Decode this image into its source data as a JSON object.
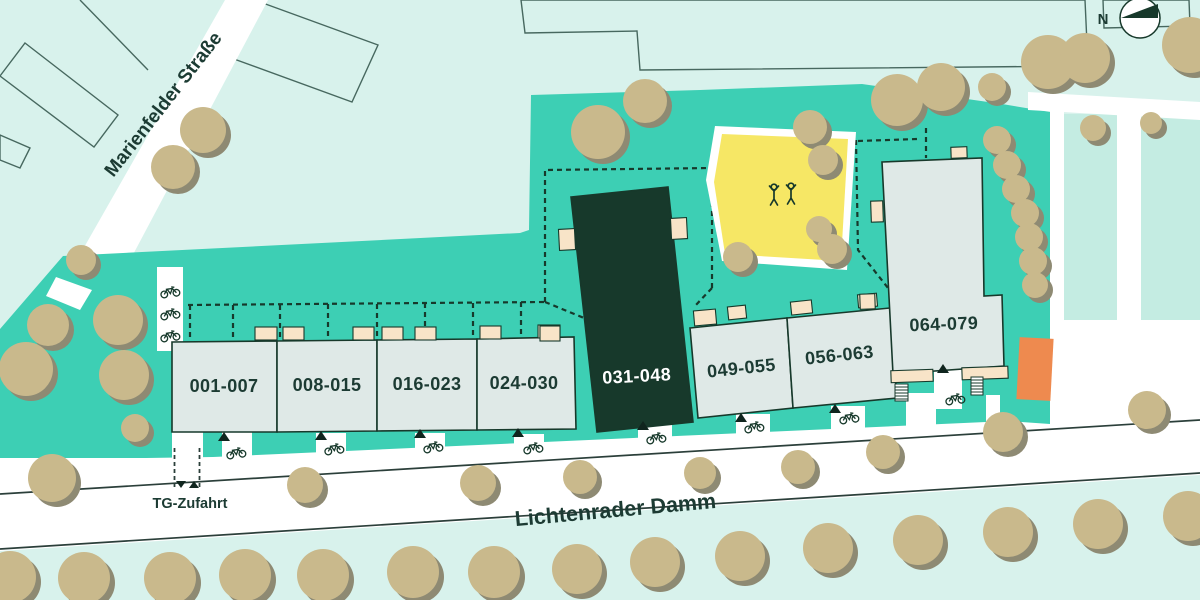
{
  "page": {
    "type": "residential-site-plan"
  },
  "streets": {
    "marienfelder": "Marienfelder Straße",
    "lichtenrader": "Lichtenrader Damm"
  },
  "labels": {
    "garage_entrance": "TG-Zufahrt",
    "compass_north": "N"
  },
  "buildings": [
    {
      "label": "001-007",
      "highlighted": false
    },
    {
      "label": "008-015",
      "highlighted": false
    },
    {
      "label": "016-023",
      "highlighted": false
    },
    {
      "label": "024-030",
      "highlighted": false
    },
    {
      "label": "031-048",
      "highlighted": true
    },
    {
      "label": "049-055",
      "highlighted": false
    },
    {
      "label": "056-063",
      "highlighted": false
    },
    {
      "label": "064-079",
      "highlighted": false
    }
  ],
  "icons": {
    "bike": "bicycle-parking-icon",
    "playground": "playground-figures-icon",
    "entrance": "entrance-triangle-icon",
    "north": "north-arrow-icon"
  },
  "colors": {
    "background": "#d8f2ec",
    "site_green": "#3dcfb4",
    "east_area_green": "#c4ece2",
    "building_fill": "#dfe9e7",
    "building_highlight": "#17392b",
    "outline_dark": "#17392b",
    "neighbor_outline": "#47685f",
    "tree_fill": "#c9b98c",
    "tree_shadow": "#8e8a73",
    "playground_yellow": "#f6e765",
    "terrace_beige": "#f8e4c8",
    "accent_orange": "#ee8a4f",
    "street_white": "#ffffff",
    "text_dark": "#1c3b33"
  }
}
